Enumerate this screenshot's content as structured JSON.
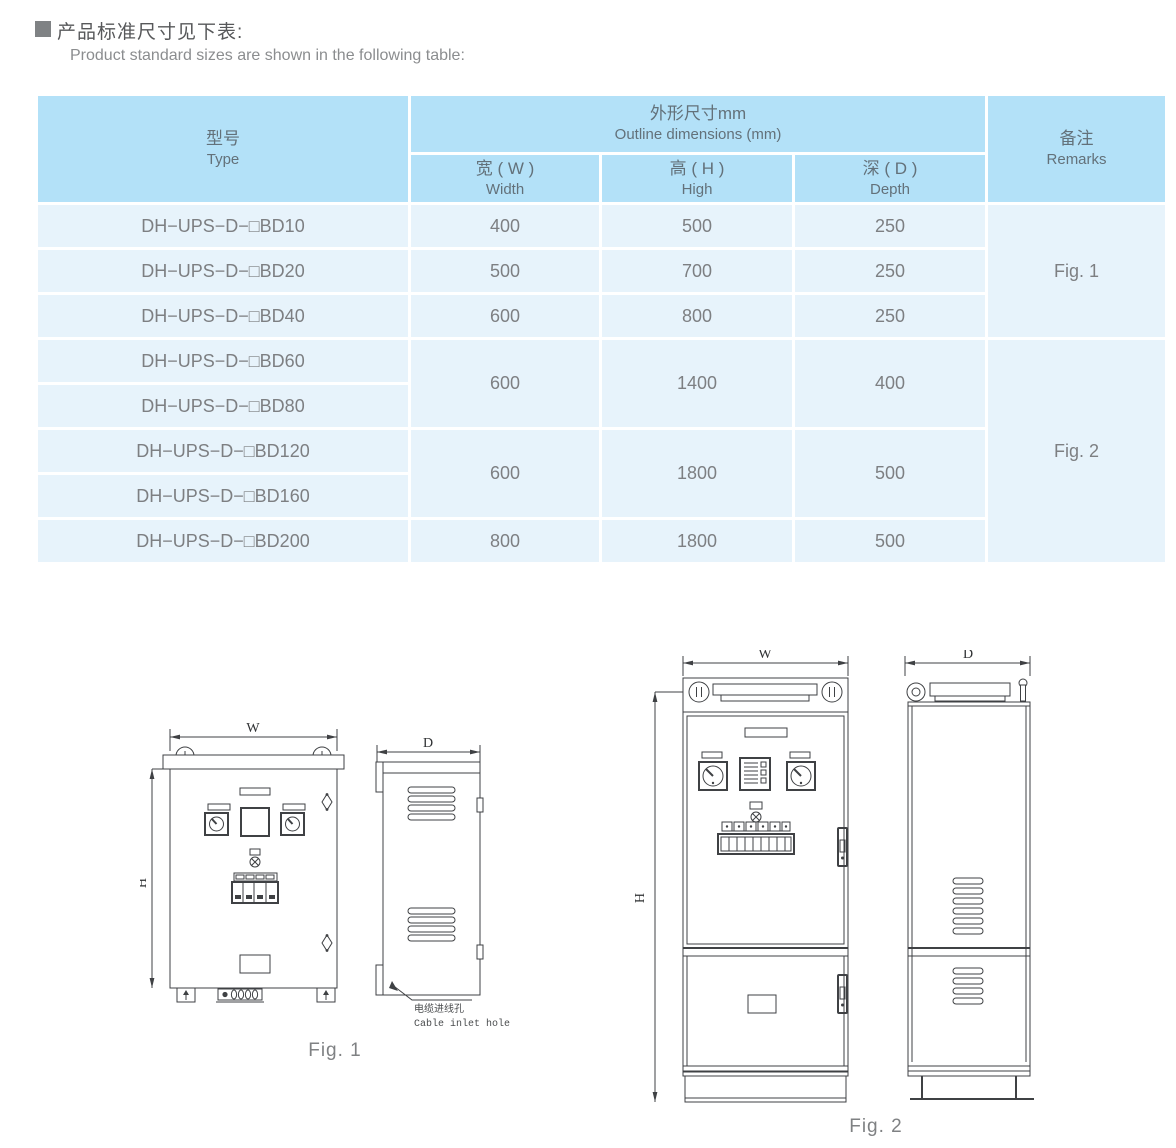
{
  "page": {
    "title_zh": "产品标准尺寸见下表:",
    "title_en": "Product standard sizes are shown in the following table:"
  },
  "table": {
    "header": {
      "type_zh": "型号",
      "type_en": "Type",
      "outline_zh": "外形尺寸mm",
      "outline_en": "Outline dimensions (mm)",
      "width_zh": "宽 ( W )",
      "width_en": "Width",
      "high_zh": "高 ( H )",
      "high_en": "High",
      "depth_zh": "深 ( D )",
      "depth_en": "Depth",
      "remarks_zh": "备注",
      "remarks_en": "Remarks"
    },
    "rows": [
      {
        "type": "DH−UPS−D−□BD10",
        "w": "400",
        "h": "500",
        "d": "250"
      },
      {
        "type": "DH−UPS−D−□BD20",
        "w": "500",
        "h": "700",
        "d": "250"
      },
      {
        "type": "DH−UPS−D−□BD40",
        "w": "600",
        "h": "800",
        "d": "250"
      },
      {
        "type": "DH−UPS−D−□BD60",
        "w": "600",
        "h": "1400",
        "d": "400"
      },
      {
        "type": "DH−UPS−D−□BD80"
      },
      {
        "type": "DH−UPS−D−□BD120",
        "w": "600",
        "h": "1800",
        "d": "500"
      },
      {
        "type": "DH−UPS−D−□BD160"
      },
      {
        "type": "DH−UPS−D−□BD200",
        "w": "800",
        "h": "1800",
        "d": "500"
      }
    ],
    "remarks": {
      "fig1": "Fig. 1",
      "fig2": "Fig. 2"
    }
  },
  "figures": {
    "fig1": {
      "caption": "Fig. 1",
      "dim_w": "W",
      "dim_h": "H",
      "dim_d": "D",
      "cable_label_zh": "电缆进线孔",
      "cable_label_en": "Cable inlet hole"
    },
    "fig2": {
      "caption": "Fig. 2",
      "dim_w": "W",
      "dim_h": "H",
      "dim_d": "D"
    }
  },
  "colors": {
    "header_bg": "#b3e1f8",
    "row_bg": "#e7f3fb",
    "header_text": "#63717a",
    "body_text": "#7d7f82",
    "line_art": "#3f4144"
  }
}
